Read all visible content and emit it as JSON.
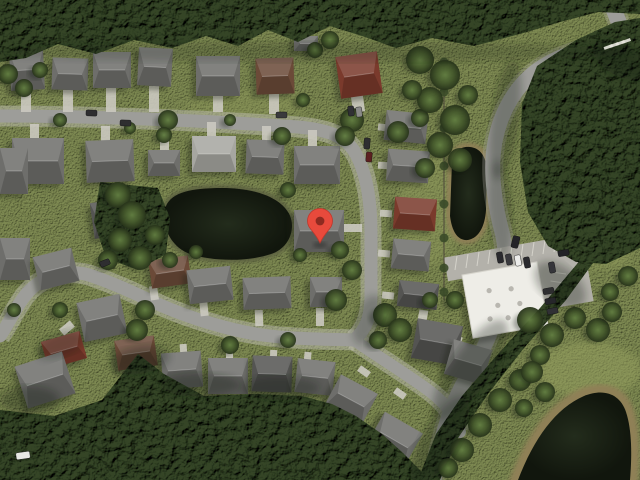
{
  "app": {
    "name": "satellite-map-view",
    "description": "aerial satellite imagery of suburban neighborhood with red location marker"
  },
  "scene": {
    "width": 640,
    "height": 480,
    "colors": {
      "grass": "#7e8a52",
      "grass_light": "#96a05e",
      "forest": "#344526",
      "forest_deep": "#243018",
      "road": "#9d9d99",
      "sidewalk": "#c6c3ba",
      "shoulder": "#b9b6ad",
      "driveway": "#cbc9c0",
      "roof_gray": "#6e6e6b",
      "roof_light": "#a6a6a0",
      "roof_dark": "#545452",
      "roof_brown": "#6b4a38",
      "roof_red": "#7a3a2c",
      "pond": "#151a10",
      "pond_rim": "#5c6140",
      "sand_rim": "#8f8057",
      "building": "#eeede7",
      "building_detail": "#b9b7b0",
      "parking": "#b3b1aa",
      "stall_line": "#dddbd2",
      "hedge": "#3a4a28",
      "pin": "#E84A3C",
      "pin_dot": "#8E2A20"
    },
    "marker": {
      "x": 320,
      "y": 243
    },
    "roads": [
      {
        "name": "top-and-vertical-street",
        "d": "M 0 116 C 80 116 200 120 298 127 C 332 130 348 138 357 156 C 366 174 371 198 371 232 L 371 296 C 371 316 366 330 354 340",
        "w": 13,
        "kind": "residential"
      },
      {
        "name": "west-s-curve-street",
        "d": "M 0 336 C 10 322 18 302 30 290 C 44 276 70 268 92 276 C 118 285 136 294 160 305 C 190 318 228 330 262 335 C 292 339 322 339 354 340",
        "w": 13,
        "kind": "residential"
      },
      {
        "name": "southeast-street",
        "d": "M 354 340 C 374 354 400 370 424 387 C 444 401 455 415 460 432",
        "w": 12,
        "kind": "residential"
      },
      {
        "name": "main-east-road",
        "d": "M 624 42 C 588 46 552 56 530 76 C 512 92 498 118 494 148 C 490 176 496 210 502 232 C 506 248 506 262 504 280 C 500 312 488 344 470 372 C 452 400 440 436 434 480",
        "w": 15,
        "kind": "collector"
      },
      {
        "name": "topright-edge-road",
        "d": "M 610 0 C 616 16 622 30 628 44 C 634 58 638 76 640 96",
        "w": 16,
        "kind": "collector"
      }
    ],
    "ponds": [
      {
        "name": "left-pond",
        "d": "M 166 206 C 172 192 192 188 222 188 C 252 188 278 196 288 212 C 296 224 292 244 276 252 C 254 262 214 262 190 254 C 170 247 160 224 166 206 Z",
        "rim": "pond_rim",
        "rimw": 3
      },
      {
        "name": "retention-pond",
        "d": "M 452 162 C 454 150 462 146 470 147 C 480 148 486 156 487 170 L 486 210 C 485 226 479 238 468 240 C 458 241 452 232 450 216 Z",
        "rim": "sand_rim",
        "rimw": 4
      },
      {
        "name": "bottomright-pond",
        "d": "M 518 480 C 534 438 556 408 584 396 C 604 388 620 394 626 412 C 632 430 632 456 630 480 Z",
        "rim": "sand_rim",
        "rimw": 8
      }
    ],
    "forests": [
      {
        "name": "top-tree-line",
        "pts": "0,0 640,0 640,14 598,12 560,22 520,34 474,46 432,38 396,48 362,36 330,26 298,42 268,30 238,46 206,36 172,48 134,40 96,54 58,44 26,58 0,62"
      },
      {
        "name": "northeast-forest",
        "pts": "640,18 615,22 576,40 537,66 522,104 520,162 528,212 548,246 576,262 606,264 640,248"
      },
      {
        "name": "bottom-forest",
        "pts": "0,410 54,416 102,400 138,354 164,374 204,396 254,394 302,396 332,404 356,416 382,434 402,452 420,470 428,480 0,480"
      },
      {
        "name": "southeast-tree-band",
        "pts": "640,198 604,248 566,300 524,348 488,394 458,438 440,480 418,480 436,434 462,396 498,354 540,308 582,258 614,214 640,178"
      },
      {
        "name": "pond-west-trees",
        "pts": "100,182 158,188 170,218 166,254 138,270 106,258 94,222"
      }
    ],
    "trees": [
      [
        168,
        120,
        10
      ],
      [
        164,
        135,
        8
      ],
      [
        282,
        136,
        9
      ],
      [
        303,
        100,
        7
      ],
      [
        352,
        120,
        12
      ],
      [
        345,
        136,
        10
      ],
      [
        398,
        132,
        11
      ],
      [
        420,
        118,
        9
      ],
      [
        60,
        120,
        7
      ],
      [
        230,
        120,
        6
      ],
      [
        130,
        128,
        6
      ],
      [
        118,
        195,
        13
      ],
      [
        132,
        215,
        14
      ],
      [
        120,
        240,
        12
      ],
      [
        140,
        258,
        12
      ],
      [
        155,
        235,
        10
      ],
      [
        108,
        260,
        10
      ],
      [
        170,
        260,
        8
      ],
      [
        196,
        252,
        7
      ],
      [
        288,
        190,
        8
      ],
      [
        340,
        250,
        9
      ],
      [
        352,
        270,
        10
      ],
      [
        336,
        300,
        11
      ],
      [
        300,
        255,
        7
      ],
      [
        420,
        60,
        14
      ],
      [
        445,
        75,
        15
      ],
      [
        430,
        100,
        13
      ],
      [
        455,
        120,
        15
      ],
      [
        440,
        145,
        13
      ],
      [
        460,
        160,
        12
      ],
      [
        425,
        168,
        10
      ],
      [
        412,
        90,
        10
      ],
      [
        468,
        95,
        10
      ],
      [
        385,
        315,
        12
      ],
      [
        400,
        330,
        12
      ],
      [
        378,
        340,
        9
      ],
      [
        430,
        300,
        8
      ],
      [
        455,
        300,
        9
      ],
      [
        145,
        310,
        10
      ],
      [
        137,
        330,
        11
      ],
      [
        230,
        345,
        9
      ],
      [
        288,
        340,
        8
      ],
      [
        60,
        310,
        8
      ],
      [
        14,
        310,
        7
      ],
      [
        530,
        320,
        13
      ],
      [
        552,
        335,
        12
      ],
      [
        575,
        318,
        11
      ],
      [
        598,
        330,
        12
      ],
      [
        612,
        312,
        10
      ],
      [
        540,
        355,
        10
      ],
      [
        520,
        380,
        11
      ],
      [
        500,
        400,
        12
      ],
      [
        480,
        425,
        12
      ],
      [
        462,
        450,
        12
      ],
      [
        448,
        468,
        10
      ],
      [
        610,
        292,
        9
      ],
      [
        628,
        276,
        10
      ],
      [
        532,
        372,
        11
      ],
      [
        545,
        392,
        10
      ],
      [
        524,
        408,
        9
      ],
      [
        8,
        74,
        10
      ],
      [
        24,
        88,
        9
      ],
      [
        40,
        70,
        8
      ],
      [
        315,
        50,
        8
      ],
      [
        330,
        40,
        9
      ]
    ],
    "houses": [
      [
        10,
        50,
        34,
        40,
        -3,
        "gray"
      ],
      [
        52,
        58,
        36,
        32,
        2,
        "gray"
      ],
      [
        93,
        52,
        38,
        36,
        0,
        "gray"
      ],
      [
        138,
        48,
        34,
        38,
        3,
        "gray"
      ],
      [
        196,
        56,
        44,
        40,
        0,
        "gray"
      ],
      [
        256,
        58,
        38,
        36,
        -2,
        "brown"
      ],
      [
        338,
        54,
        42,
        42,
        -8,
        "red"
      ],
      [
        294,
        36,
        24,
        15,
        0,
        "gray"
      ],
      [
        12,
        138,
        52,
        46,
        0,
        "gray"
      ],
      [
        86,
        140,
        48,
        42,
        -2,
        "gray"
      ],
      [
        148,
        150,
        32,
        26,
        0,
        "gray"
      ],
      [
        192,
        136,
        44,
        36,
        0,
        "light"
      ],
      [
        246,
        140,
        38,
        34,
        2,
        "gray"
      ],
      [
        294,
        146,
        46,
        38,
        0,
        "gray"
      ],
      [
        385,
        112,
        42,
        30,
        6,
        "gray"
      ],
      [
        387,
        150,
        42,
        32,
        4,
        "gray"
      ],
      [
        394,
        198,
        42,
        32,
        4,
        "red"
      ],
      [
        392,
        240,
        38,
        30,
        5,
        "gray"
      ],
      [
        398,
        282,
        40,
        26,
        6,
        "dark"
      ],
      [
        414,
        322,
        46,
        40,
        10,
        "dark"
      ],
      [
        448,
        344,
        40,
        36,
        16,
        "gray"
      ],
      [
        294,
        210,
        50,
        42,
        0,
        "gray"
      ],
      [
        0,
        148,
        28,
        46,
        0,
        "gray"
      ],
      [
        0,
        238,
        30,
        42,
        0,
        "gray"
      ],
      [
        92,
        200,
        44,
        36,
        -8,
        "dark"
      ],
      [
        36,
        252,
        40,
        34,
        -14,
        "gray"
      ],
      [
        150,
        258,
        40,
        28,
        -8,
        "brown"
      ],
      [
        188,
        268,
        44,
        34,
        -6,
        "gray"
      ],
      [
        243,
        277,
        48,
        32,
        -2,
        "gray"
      ],
      [
        310,
        277,
        32,
        30,
        0,
        "gray"
      ],
      [
        80,
        298,
        44,
        40,
        -12,
        "gray"
      ],
      [
        44,
        336,
        40,
        28,
        -16,
        "red"
      ],
      [
        20,
        358,
        50,
        44,
        -18,
        "gray"
      ],
      [
        116,
        338,
        40,
        30,
        -8,
        "brown"
      ],
      [
        162,
        352,
        40,
        36,
        -4,
        "gray"
      ],
      [
        208,
        358,
        40,
        36,
        0,
        "gray"
      ],
      [
        252,
        356,
        40,
        36,
        2,
        "dark"
      ],
      [
        296,
        360,
        38,
        34,
        6,
        "gray"
      ],
      [
        330,
        382,
        42,
        36,
        28,
        "gray"
      ],
      [
        372,
        420,
        44,
        40,
        30,
        "gray"
      ],
      [
        0,
        424,
        30,
        36,
        4,
        "brown"
      ],
      [
        34,
        430,
        30,
        26,
        10,
        "gray"
      ]
    ],
    "driveways": [
      [
        21,
        90,
        10,
        22,
        0
      ],
      [
        63,
        90,
        10,
        22,
        0
      ],
      [
        106,
        88,
        10,
        24,
        0
      ],
      [
        149,
        86,
        10,
        26,
        0
      ],
      [
        213,
        96,
        10,
        16,
        0
      ],
      [
        269,
        94,
        10,
        20,
        0
      ],
      [
        352,
        96,
        12,
        16,
        -8
      ],
      [
        30,
        124,
        9,
        16,
        0
      ],
      [
        101,
        126,
        9,
        16,
        0
      ],
      [
        160,
        132,
        9,
        18,
        0
      ],
      [
        207,
        122,
        9,
        16,
        0
      ],
      [
        262,
        126,
        9,
        16,
        0
      ],
      [
        308,
        130,
        9,
        18,
        0
      ],
      [
        378,
        124,
        12,
        7,
        6
      ],
      [
        378,
        162,
        12,
        7,
        4
      ],
      [
        380,
        210,
        12,
        7,
        4
      ],
      [
        378,
        250,
        12,
        7,
        5
      ],
      [
        382,
        292,
        12,
        7,
        6
      ],
      [
        344,
        224,
        18,
        8,
        0
      ],
      [
        150,
        286,
        8,
        14,
        -8
      ],
      [
        200,
        302,
        8,
        14,
        -6
      ],
      [
        255,
        310,
        8,
        16,
        -2
      ],
      [
        316,
        308,
        8,
        18,
        0
      ],
      [
        60,
        324,
        14,
        8,
        -40
      ],
      [
        132,
        352,
        7,
        12,
        -8
      ],
      [
        180,
        344,
        7,
        12,
        -4
      ],
      [
        226,
        350,
        7,
        12,
        0
      ],
      [
        270,
        350,
        7,
        12,
        2
      ],
      [
        304,
        352,
        7,
        12,
        6
      ],
      [
        358,
        368,
        12,
        7,
        35
      ],
      [
        394,
        390,
        12,
        7,
        35
      ],
      [
        418,
        310,
        9,
        16,
        10
      ],
      [
        452,
        336,
        9,
        14,
        16
      ]
    ],
    "building": {
      "name": "white-commercial-building",
      "cx": 505,
      "cy": 300,
      "w": 76,
      "h": 64,
      "r": -10,
      "vents": [
        [
          -14,
          -12
        ],
        [
          8,
          -10
        ],
        [
          -8,
          4
        ],
        [
          14,
          6
        ],
        [
          0,
          18
        ],
        [
          -18,
          16
        ]
      ]
    },
    "parking": {
      "rects": [
        [
          445,
          246,
          132,
          24,
          -10
        ],
        [
          538,
          260,
          52,
          46,
          -10
        ]
      ],
      "stall_rows": [
        {
          "x0": 455,
          "y0": 270,
          "dx": 11,
          "dy": -2,
          "len": 14,
          "vert": true,
          "count": 11
        },
        {
          "x0": 552,
          "y0": 272,
          "dx": -1.5,
          "dy": 9,
          "len": 14,
          "vert": false,
          "count": 4
        }
      ]
    },
    "hedge": {
      "x": 444,
      "y0": 58,
      "y1": 300,
      "bushes": [
        62,
        92,
        128,
        166,
        204,
        238,
        268,
        292
      ]
    },
    "cars": [
      [
        86,
        110,
        11,
        6,
        2,
        "#2e2e30"
      ],
      [
        120,
        120,
        11,
        6,
        2,
        "#2e2e30"
      ],
      [
        276,
        112,
        11,
        6,
        0,
        "#3a3a3c"
      ],
      [
        364,
        138,
        6,
        11,
        4,
        "#2e2e30"
      ],
      [
        366,
        152,
        6,
        10,
        4,
        "#5c2020"
      ],
      [
        348,
        106,
        6,
        10,
        -6,
        "#303034"
      ],
      [
        356,
        107,
        6,
        10,
        -6,
        "#8a8a88"
      ],
      [
        100,
        260,
        10,
        6,
        -22,
        "#2e2e30"
      ],
      [
        16,
        452,
        14,
        7,
        -8,
        "#e8e8e4"
      ],
      [
        497,
        252,
        6,
        11,
        -10,
        "#2a2a2e"
      ],
      [
        506,
        254,
        6,
        11,
        -10,
        "#3a3a3e"
      ],
      [
        515,
        255,
        6,
        11,
        -10,
        "#ececea"
      ],
      [
        524,
        257,
        6,
        11,
        -10,
        "#2a2a2e"
      ],
      [
        549,
        262,
        6,
        11,
        -10,
        "#35353a"
      ],
      [
        558,
        250,
        11,
        6,
        -10,
        "#222226"
      ],
      [
        543,
        288,
        11,
        6,
        -10,
        "#2e2e30"
      ],
      [
        545,
        298,
        11,
        6,
        -10,
        "#26262a"
      ],
      [
        547,
        308,
        11,
        6,
        -10,
        "#303034"
      ],
      [
        512,
        236,
        7,
        12,
        14,
        "#242428"
      ]
    ],
    "crosswalk": [
      [
        612,
        44
      ],
      [
        618,
        42
      ],
      [
        624,
        40
      ],
      [
        630,
        38
      ]
    ],
    "shadows": [
      [
        505,
        120,
        14,
        60,
        8,
        0.28
      ],
      [
        500,
        210,
        12,
        50,
        -4,
        0.25
      ],
      [
        470,
        370,
        20,
        60,
        35,
        0.3
      ],
      [
        440,
        440,
        18,
        50,
        30,
        0.3
      ],
      [
        560,
        285,
        30,
        18,
        40,
        0.3
      ],
      [
        140,
        360,
        30,
        14,
        -10,
        0.3
      ],
      [
        200,
        385,
        40,
        12,
        0,
        0.28
      ],
      [
        280,
        388,
        40,
        12,
        0,
        0.25
      ],
      [
        60,
        345,
        25,
        12,
        -20,
        0.25
      ],
      [
        30,
        400,
        30,
        14,
        0,
        0.3
      ],
      [
        620,
        60,
        30,
        16,
        30,
        0.3
      ],
      [
        368,
        320,
        14,
        26,
        20,
        0.25
      ],
      [
        320,
        52,
        320,
        10,
        0,
        0.18
      ]
    ],
    "grass_patches": [
      [
        590,
        370,
        52,
        28,
        0,
        0.5
      ],
      [
        430,
        210,
        30,
        55,
        0,
        0.35
      ],
      [
        245,
        105,
        60,
        14,
        0,
        0.3
      ],
      [
        600,
        255,
        30,
        14,
        0,
        0.4
      ]
    ]
  }
}
